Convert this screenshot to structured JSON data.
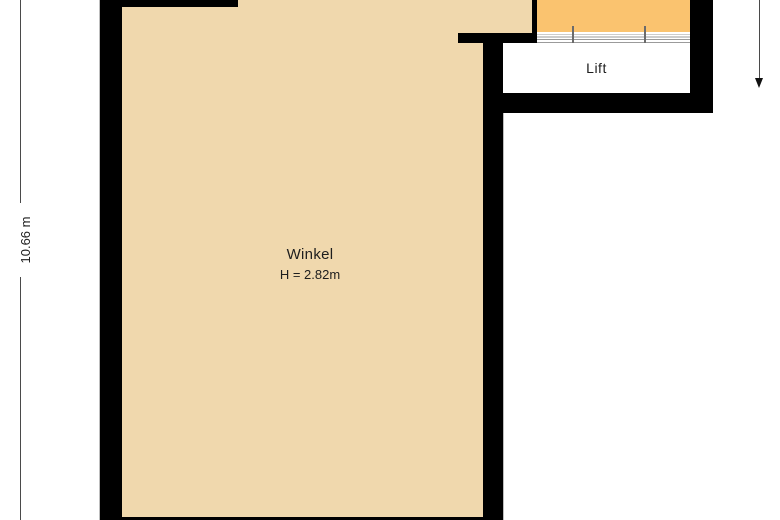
{
  "document": {
    "type": "floor-plan"
  },
  "rooms": {
    "winkel": {
      "label": "Winkel",
      "height": "H = 2.82m",
      "floor_color": "#f0d8ad"
    },
    "lift": {
      "label": "Lift",
      "floor_color": "#ffffff"
    },
    "shaft": {
      "label": "",
      "floor_color": "#fac36f"
    }
  },
  "dimensions": {
    "left_label": "10.66 m"
  },
  "colors": {
    "wall": "#000000",
    "floor_beige": "#f0d8ad",
    "shaft_orange": "#fac36f",
    "hatch_line": "#9b9b9b",
    "dimension_line": "#4a4a4a",
    "text": "#1e1e1e",
    "background": "#ffffff"
  }
}
